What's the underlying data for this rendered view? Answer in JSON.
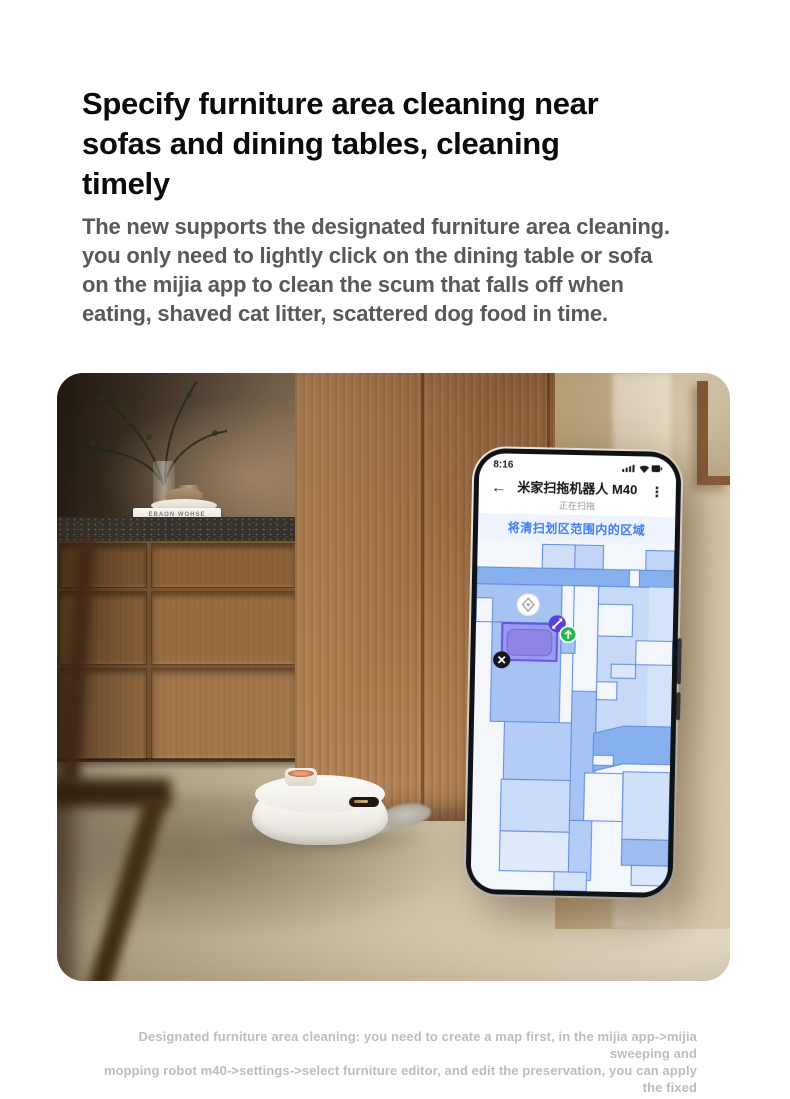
{
  "heading": {
    "lines": [
      "Specify furniture area cleaning near",
      "sofas and dining tables, cleaning",
      "timely"
    ]
  },
  "body": {
    "lines": [
      "The new supports the designated furniture area cleaning.",
      "you only need to lightly click on the dining table or sofa",
      "on the mijia app to clean the scum that falls off when",
      "eating, shaved cat litter, scattered dog food in time."
    ]
  },
  "footnote": {
    "lines": [
      "Designated furniture area cleaning: you need to create a map first, in the mijia app->mijia sweeping and",
      "mopping robot m40->settings->select furniture editor, and edit the preservation, you can apply the fixed",
      "point area by clicking on the furniture to clean."
    ]
  },
  "photo": {
    "book_spine": "EBAON WOHSE"
  },
  "phone": {
    "status_bar": {
      "time": "8:16",
      "icons": [
        "signal-icon",
        "wifi-icon",
        "battery-icon"
      ]
    },
    "app_bar": {
      "back_glyph": "←",
      "title": "米家扫拖机器人 M40",
      "subtitle": "正在扫拖",
      "menu_glyph": "⋮"
    },
    "banner": {
      "text": "将清扫划区范围内的区域",
      "color": "#3e7df0"
    },
    "map": {
      "colors": {
        "background": "#f3f7fc",
        "room_medium_blue": "#87b0ee",
        "room_periwinkle": "#a6c3f4",
        "room_pale_blue": "#c6daf8",
        "room_faint_blue": "#dbe7fc",
        "outline": "#5f8bd9",
        "zone_fill": "#7b63eb",
        "zone_border": "#6c52e0",
        "dock_icon": "#ffffff",
        "resize_handle": "#5b3fd9",
        "robot_marker": "#27b54e",
        "remove_button": "#17171b"
      }
    }
  }
}
